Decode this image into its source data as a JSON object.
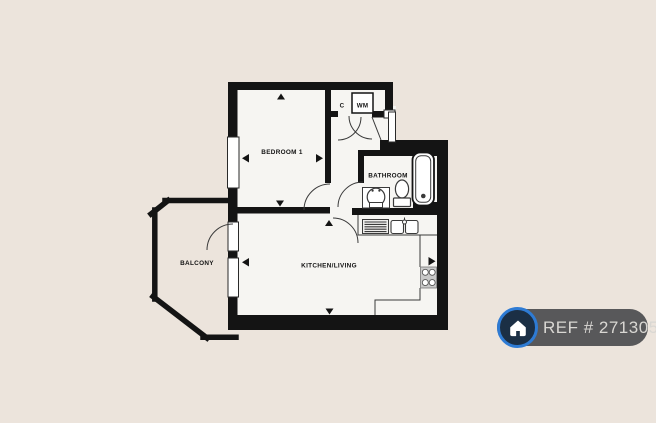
{
  "page": {
    "background": "#ece4dc"
  },
  "plan": {
    "colors": {
      "wall": "#141414",
      "floor": "#f6f5f2",
      "line": "#3a3a3a",
      "hob_fill": "#c9c9c9"
    },
    "rooms": [
      {
        "id": "bedroom-1",
        "label": "BEDROOM 1"
      },
      {
        "id": "bathroom",
        "label": "BATHROOM"
      },
      {
        "id": "kitchen-living",
        "label": "KITCHEN/LIVING"
      },
      {
        "id": "balcony",
        "label": "BALCONY"
      },
      {
        "id": "cupboard",
        "label": "C"
      },
      {
        "id": "washing-machine",
        "label": "WM"
      }
    ]
  },
  "badge": {
    "label": "REF # 2713052",
    "colors": {
      "background": "#58585a",
      "text": "#d9d7d3",
      "icon_ring": "#2e7bd4",
      "icon_background": "#1b2f45",
      "icon_glyph": "#ffffff"
    }
  }
}
